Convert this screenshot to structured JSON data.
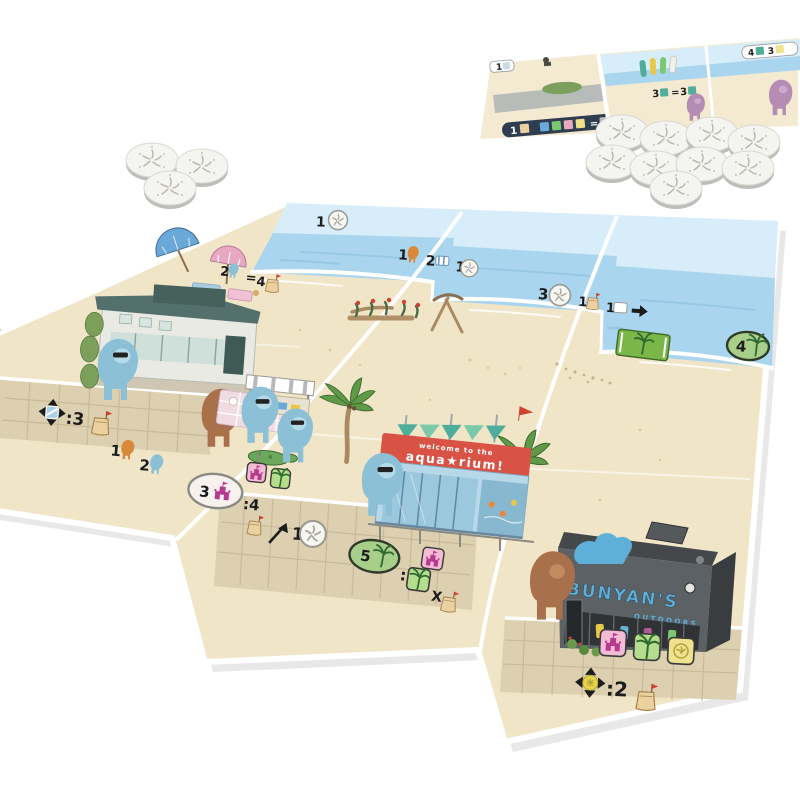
{
  "palette": {
    "bg": "#ffffff",
    "ink": "#1c1c1c",
    "sky": "#d8edfa",
    "ocean": "#a9d6ee",
    "ocean_streak": "#8fc3e0",
    "sand": "#f1e5c8",
    "sand_dot": "#d9c9a4",
    "boardwalk": "#ddd0b1",
    "plank": "#c3b28e",
    "token_top": "#f4f4f1",
    "token_side": "#bdbdb9",
    "token_edge": "#d8d8d3",
    "token_mark": "#b9b5aa",
    "meeple_blue": "#8cc0d6",
    "meeple_blue_face": "#b5dbe9",
    "meeple_brown": "#a9714b",
    "meeple_brown_face": "#c18a5f",
    "meeple_purple": "#b48cb4",
    "meeple_purple_face": "#cbaacb",
    "icon_orange": "#d88a3a",
    "badge_green": "#a8cf8a",
    "badge_outline": "#2f3b2a",
    "oval_gray_outline": "#8a8a84",
    "sign_pink": "#f4bcd4",
    "sign_pink_icon": "#b73a8e",
    "sign_green": "#b5dd8e",
    "sign_green_icon": "#2f6b2f",
    "sign_yellow": "#efe28e",
    "sign_yellow_icon": "#b3a23c",
    "bag": "#ecd1a0",
    "bag_outline": "#a8834f",
    "flag_red": "#cc4433",
    "banner_red": "#d85346",
    "aqua_wall": "#b7d8e9",
    "aqua_glass": "#9cc8de",
    "aqua_frame": "#5f8aa8",
    "awning_teal": "#4fae9b",
    "house_wall": "#e9eae4",
    "house_roof": "#54706c",
    "store_front": "#5c6165",
    "store_roof": "#44484b",
    "store_side": "#393d40",
    "store_blue": "#5fb0d8",
    "palm_leaf": "#5f9a48",
    "palm_leaf_dark": "#3f6b30",
    "palm_trunk": "#a98a62"
  },
  "tokens": {
    "left_cluster_count": 3,
    "right_cluster_count": 9
  },
  "supply_boards": {
    "left": {
      "corner": "1",
      "strip": "1"
    },
    "right": {
      "trade": {
        "a": "3",
        "eq": "=",
        "b": "3"
      },
      "corner": {
        "a": "4",
        "b": "3"
      }
    }
  },
  "board": {
    "sky_labels": {
      "tile1": "1",
      "income": {
        "a": "1",
        "b": "2",
        "c": "1"
      },
      "trade_left": {
        "a": "2",
        "eq": "=",
        "b": "4"
      },
      "tile3": "3",
      "gain_right": {
        "a": "1",
        "b": "1"
      },
      "palm_tile": "4"
    },
    "walk_labels": {
      "move_left": ":3",
      "meeples": {
        "orange": "1",
        "blue": "2"
      },
      "castle": {
        "a": "3",
        "b": ":4"
      },
      "tile2": "1",
      "palm": {
        "a": "5",
        "colon": ":",
        "x": "X"
      },
      "move_right": ":2"
    },
    "aquarium": {
      "banner_top": "welcome to the",
      "banner_main": "aqua★rium!"
    },
    "bunyans": {
      "name": "BUNYAN'S",
      "subtitle": "OUTDOORS"
    }
  }
}
